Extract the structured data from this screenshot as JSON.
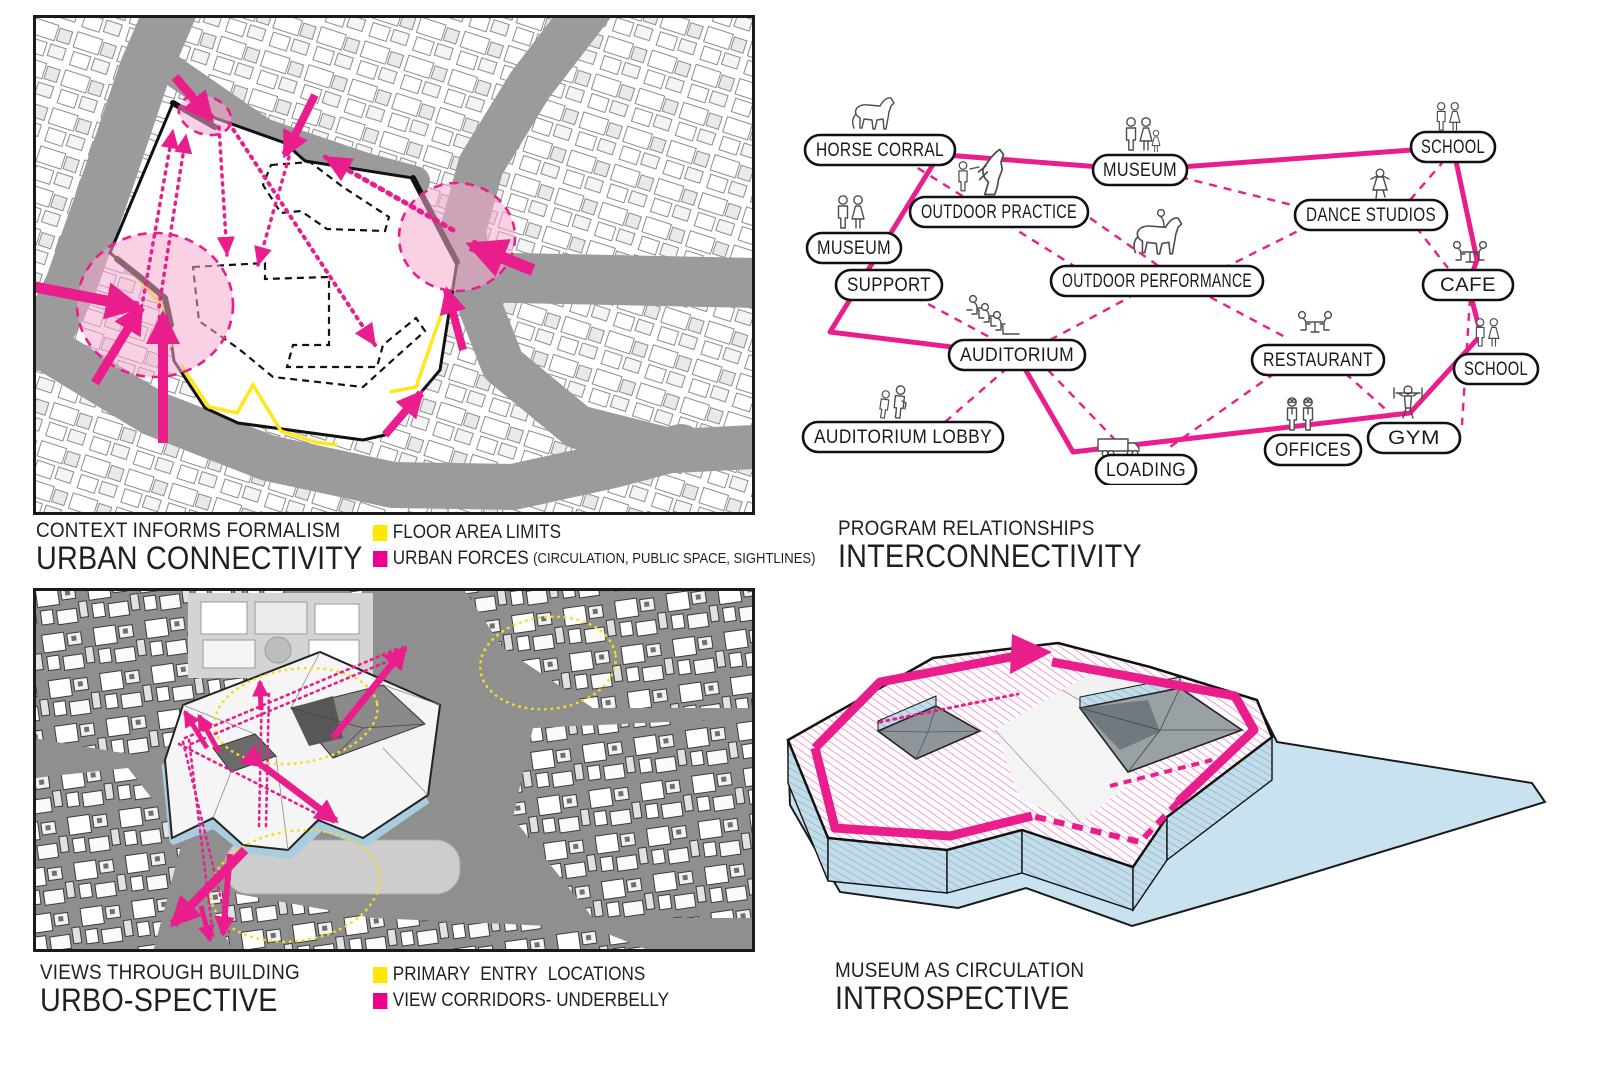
{
  "panel_urban_connectivity": {
    "caption_line1": "CONTEXT INFORMS FORMALISM",
    "caption_line2": "URBAN CONNECTIVITY",
    "legend": {
      "floor_area_limits": "FLOOR AREA LIMITS",
      "urban_forces": "URBAN FORCES",
      "urban_forces_note": "(CIRCULATION, PUBLIC SPACE, SIGHTLINES)"
    }
  },
  "panel_interconnectivity": {
    "caption_line1": "PROGRAM RELATIONSHIPS",
    "caption_line2": "INTERCONNECTIVITY",
    "nodes": [
      {
        "id": "horse-corral",
        "label": "HORSE CORRAL",
        "icon": "horse-icon"
      },
      {
        "id": "outdoor-practice",
        "label": "OUTDOOR PRACTICE",
        "icon": "trainer-rearing-horse-icon"
      },
      {
        "id": "museum-west",
        "label": "MUSEUM",
        "icon": "visitor-couple-icon"
      },
      {
        "id": "support",
        "label": "SUPPORT",
        "icon": ""
      },
      {
        "id": "museum-north",
        "label": "MUSEUM",
        "icon": "visitor-family-icon"
      },
      {
        "id": "school-north",
        "label": "SCHOOL",
        "icon": "children-icon"
      },
      {
        "id": "dance-studios",
        "label": "DANCE STUDIOS",
        "icon": "dancer-icon"
      },
      {
        "id": "outdoor-performance",
        "label": "OUTDOOR PERFORMANCE",
        "icon": "horse-rider-icon"
      },
      {
        "id": "cafe",
        "label": "CAFE",
        "icon": "cafe-table-icon"
      },
      {
        "id": "auditorium",
        "label": "AUDITORIUM",
        "icon": "seated-audience-icon"
      },
      {
        "id": "restaurant",
        "label": "RESTAURANT",
        "icon": "dining-table-icon"
      },
      {
        "id": "school-east",
        "label": "SCHOOL",
        "icon": "children-icon"
      },
      {
        "id": "auditorium-lobby",
        "label": "AUDITORIUM LOBBY",
        "icon": "walking-visitors-icon"
      },
      {
        "id": "loading",
        "label": "LOADING",
        "icon": "truck-icon"
      },
      {
        "id": "offices",
        "label": "OFFICES",
        "icon": "business-people-icon"
      },
      {
        "id": "gym",
        "label": "GYM",
        "icon": "weightlifter-icon"
      }
    ]
  },
  "panel_urbo_spective": {
    "caption_line1": "VIEWS THROUGH BUILDING",
    "caption_line2": "URBO-SPECTIVE",
    "legend": {
      "primary_entry": "PRIMARY ENTRY LOCATIONS",
      "view_corridors": "VIEW CORRIDORS- UNDERBELLY"
    }
  },
  "panel_introspective": {
    "caption_line1": "MUSEUM AS CIRCULATION",
    "caption_line2": "INTROSPECTIVE"
  },
  "colors": {
    "magenta": "#EC008C",
    "yellow": "#FFE800",
    "street_gray": "#9B9B9B",
    "underbelly_blue": "#AFCFDF"
  }
}
